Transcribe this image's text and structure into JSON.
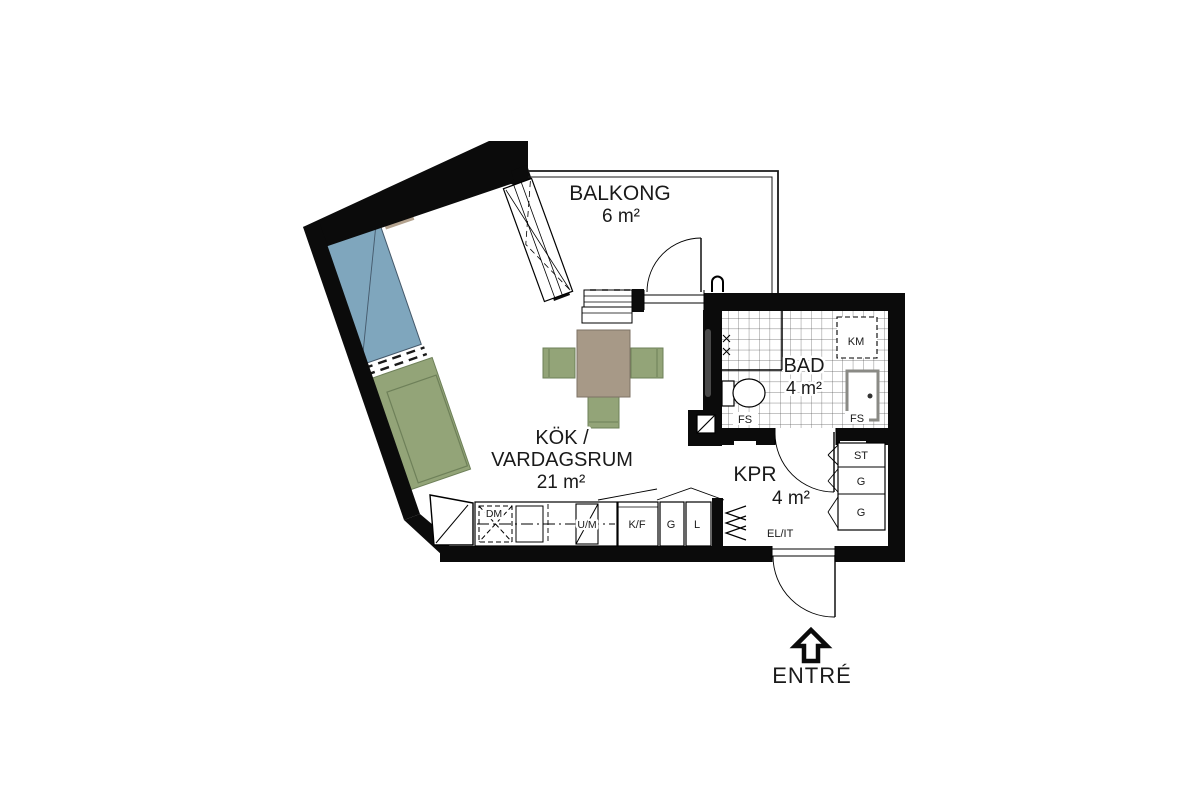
{
  "plan": {
    "rooms": {
      "balcony": {
        "name": "BALKONG",
        "area": "6 m²"
      },
      "living": {
        "name_line1": "KÖK /",
        "name_line2": "VARDAGSRUM",
        "area": "21 m²"
      },
      "bath": {
        "name": "BAD",
        "area": "4 m²"
      },
      "kpr": {
        "name": "KPR",
        "area": "4 m²"
      }
    },
    "kitchen_units": {
      "dm": "DM",
      "um": "U/M",
      "kf": "K/F",
      "g": "G",
      "l": "L"
    },
    "bath_items": {
      "km": "KM",
      "fs_left": "FS",
      "fs_right": "FS"
    },
    "closets": {
      "st": "ST",
      "g1": "G",
      "g2": "G"
    },
    "electrical_panel": "EL/IT",
    "entrance": "ENTRÉ",
    "colors": {
      "background": "#ffffff",
      "wall": "#0b0b0b",
      "bed": "#7fa6bd",
      "bed_outline": "#44586a",
      "pillow": "#b3a28e",
      "green": "#93a478",
      "green_dark": "#6e8059",
      "table": "#a79987",
      "table_dark": "#7d7264",
      "basin_gray": "#8a8a85"
    }
  }
}
